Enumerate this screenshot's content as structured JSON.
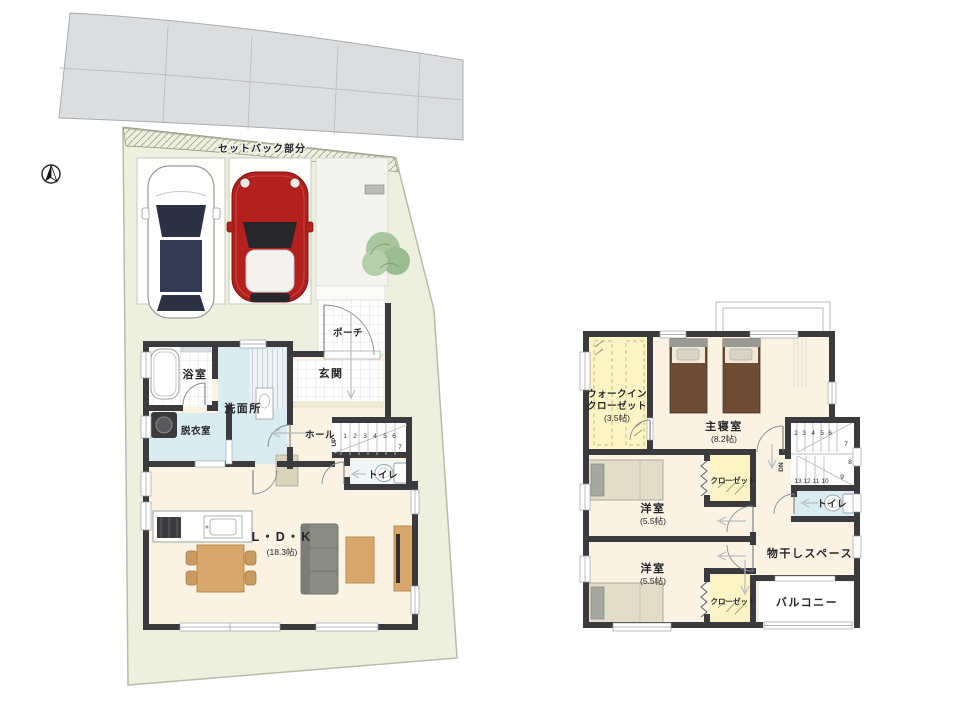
{
  "palette": {
    "wall": "#3b3b3d",
    "floor_cream": "#faf3e4",
    "floor_blue": "#d9ecf2",
    "floor_yellow": "#fcf4c5",
    "site_green": "#edf0de",
    "road_gray": "#dcddde",
    "wood_accent": "#d8a76b",
    "shoe_cabinet": "#e9bc8b",
    "bed_brown": "#6e4b33",
    "sofa_gray": "#8c8c86",
    "car_red": "#b3201d",
    "tree_green": "#a9c79f"
  },
  "site": {
    "setback_label": "セットバック部分",
    "compass_icon": "north-arrow"
  },
  "floor1": {
    "rooms": {
      "porch": "ポーチ",
      "entrance": "玄関",
      "bath": "浴室",
      "washroom": "洗面所",
      "dressing": "脱衣室",
      "hall": "ホール",
      "toilet": "トイレ",
      "ldk": "L・D・K",
      "ldk_size": "(18.3帖)"
    },
    "stairs": {
      "numbers": [
        "1",
        "2",
        "3",
        "4",
        "5",
        "6"
      ],
      "turn": "7",
      "direction": "UP"
    }
  },
  "floor2": {
    "rooms": {
      "wic_line1": "ウォークイン",
      "wic_line2": "クローゼット",
      "wic_size": "(3.5帖)",
      "master": "主寝室",
      "master_size": "(8.2帖)",
      "closet1": "クローゼット",
      "room1": "洋室",
      "room1_size": "(5.5帖)",
      "toilet": "トイレ",
      "drying": "物干しスペース",
      "room2": "洋室",
      "room2_size": "(5.5帖)",
      "closet2": "クローゼット",
      "balcony": "バルコニー"
    },
    "stairs": {
      "top_numbers": [
        "2",
        "3",
        "4",
        "5",
        "6"
      ],
      "mid_numbers": [
        "7",
        "8",
        "9"
      ],
      "bottom_numbers": [
        "13",
        "12",
        "11",
        "10"
      ],
      "direction": "DN"
    }
  }
}
